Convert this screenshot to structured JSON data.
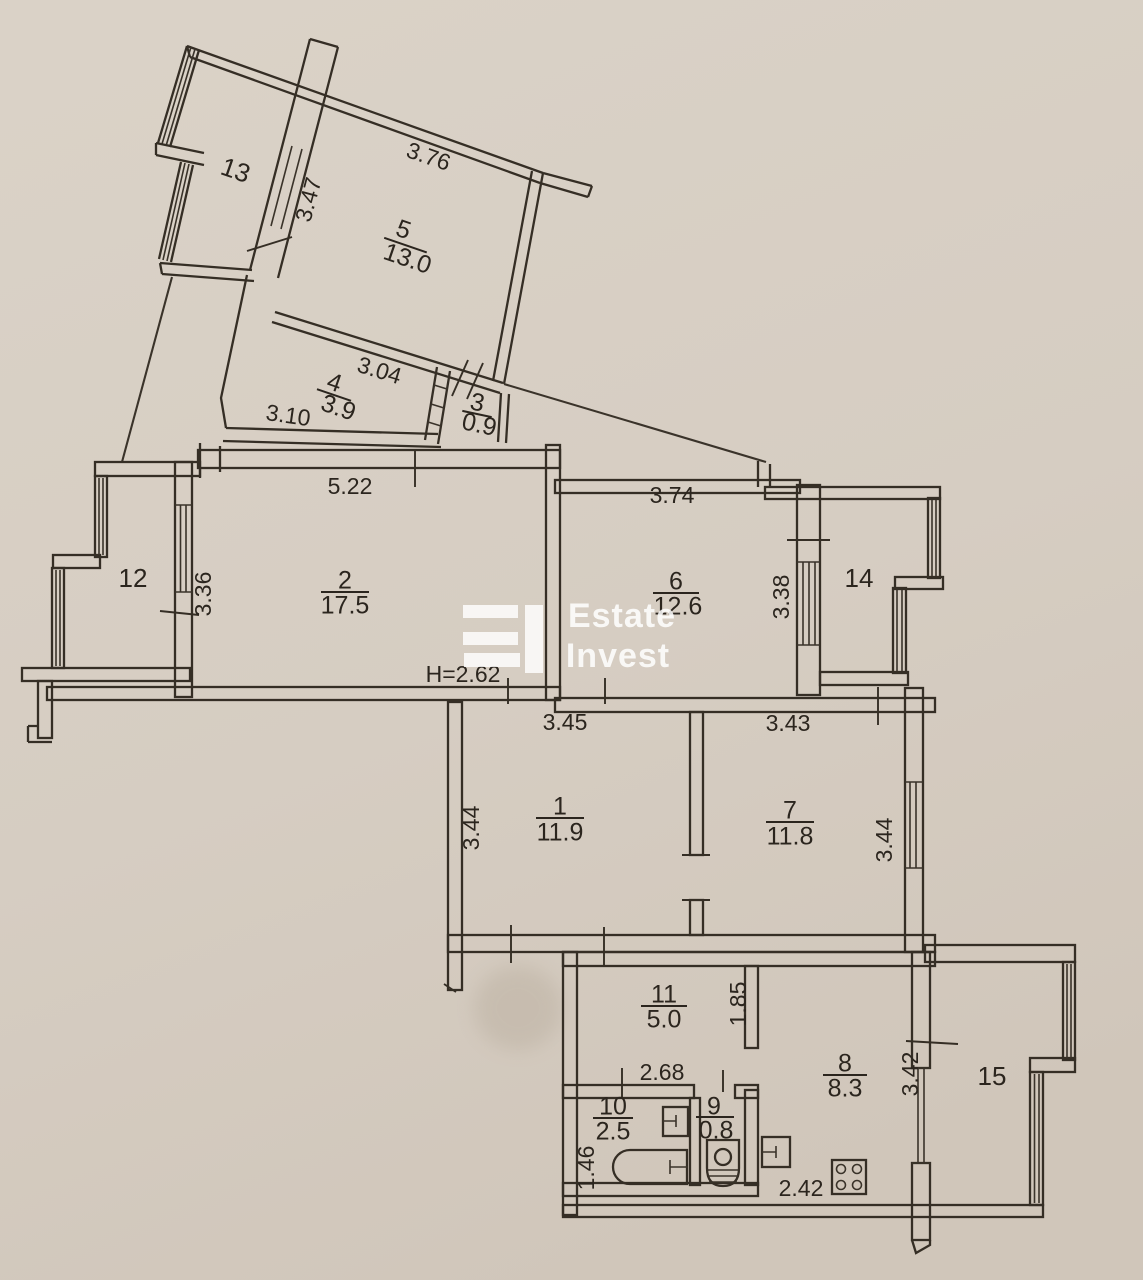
{
  "plan": {
    "title": "apartment-floor-plan-scan",
    "height_note": "H=2.62",
    "watermark": {
      "line1": "Estate",
      "line2": "Invest"
    },
    "rooms": {
      "r1": {
        "num": "1",
        "area": "11.9"
      },
      "r2": {
        "num": "2",
        "area": "17.5"
      },
      "r3": {
        "num": "3",
        "area": "0.9"
      },
      "r4": {
        "num": "4",
        "area": "3.9"
      },
      "r5": {
        "num": "5",
        "area": "13.0"
      },
      "r6": {
        "num": "6",
        "area": "12.6"
      },
      "r7": {
        "num": "7",
        "area": "11.8"
      },
      "r8": {
        "num": "8",
        "area": "8.3"
      },
      "r9": {
        "num": "9",
        "area": "0.8"
      },
      "r10": {
        "num": "10",
        "area": "2.5"
      },
      "r11": {
        "num": "11",
        "area": "5.0"
      }
    },
    "balconies": {
      "b12": {
        "num": "12"
      },
      "b13": {
        "num": "13"
      },
      "b14": {
        "num": "14"
      },
      "b15": {
        "num": "15"
      }
    },
    "dimensions": {
      "room5_top": "3.76",
      "room5_left": "3.47",
      "room4_top": "3.04",
      "room4_bottom": "3.10",
      "room2_top": "5.22",
      "room2_left": "3.36",
      "room6_top": "3.74",
      "room6_right": "3.38",
      "room1_top": "3.45",
      "room1_left": "3.44",
      "room7_top": "3.43",
      "room7_right": "3.44",
      "room11_right": "1.85",
      "room11_bottom": "2.68",
      "room10_left": "1.46",
      "room8_right": "3.42",
      "room8_bottom": "2.42"
    },
    "colors": {
      "paper": "#d6cdc2",
      "ink": "#352e25",
      "watermark": "#ffffff"
    }
  }
}
